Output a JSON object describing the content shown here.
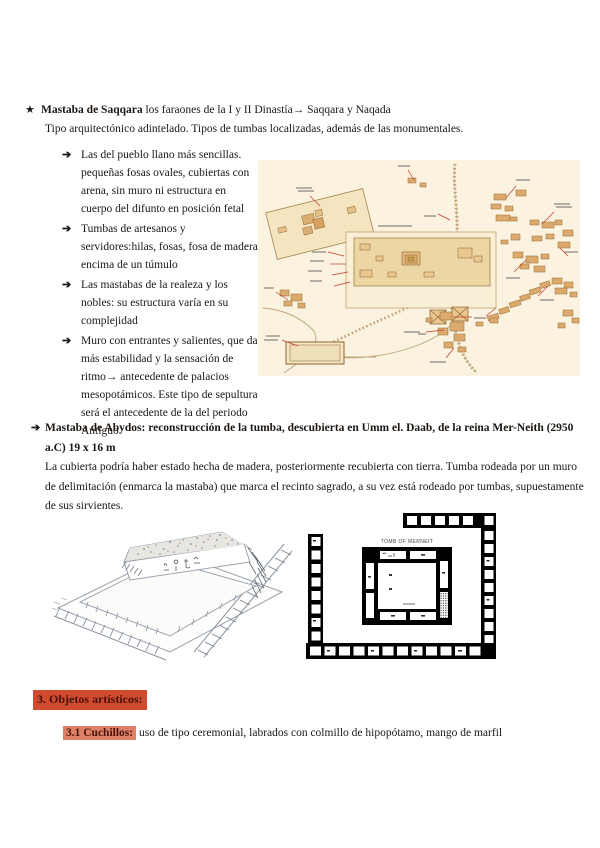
{
  "icons": {
    "star": "★",
    "arrow": "➔"
  },
  "section1": {
    "title_bold": "Mastaba de Saqqara",
    "title_rest": " los faraones de la I y II Dinastía→ Saqqara y Naqada",
    "intro": "Tipo arquitectónico adintelado. Tipos de tumbas localizadas, además de las monumentales.",
    "bullets": [
      "Las del pueblo llano más sencillas. pequeñas fosas ovales, cubiertas con arena, sin muro ni estructura en cuerpo del difunto en posición fetal",
      "Tumbas de artesanos y servidores:hilas, fosas, fosa de madera encima de un túmulo",
      "Las mastabas de la realeza y los nobles: su estructura varía en su complejidad",
      "Muro con entrantes y salientes, que da más estabilidad y la sensación de ritmo→ antecedente de palacios mesopotámicos. Este tipo de sepultura será el antecedente de la del periodo Antiguo."
    ]
  },
  "section2": {
    "title": "Mastaba de Abydos: reconstrucción de la tumba, descubierta en Umm el. Daab, de la reina Mer-Neith (2950 a.C) 19 x 16 m",
    "body": "La cubierta podría haber estado hecha de madera, posteriormente recubierta con tierra. Tumba rodeada por un muro de delimitación (enmarca la mastaba) que marca el recinto sagrado, a su vez está rodeado por tumbas, supuestamente de sus sirvientes."
  },
  "figures": {
    "plan_title": "TOMB OF MERNEIT"
  },
  "section3": {
    "heading": "3. Objetos artísticos:",
    "sub_heading": "3.1 Cuchillos:",
    "sub_body": " uso de tipo ceremonial, labrados con colmillo de hipopótamo, mango de marfil"
  },
  "colors": {
    "highlight_strong_bg": "#d14b31",
    "highlight_soft_bg": "#dd8066",
    "map_bg": "#fbf2df",
    "map_building": "#dcaa6c",
    "leader_red": "#c23b27"
  }
}
